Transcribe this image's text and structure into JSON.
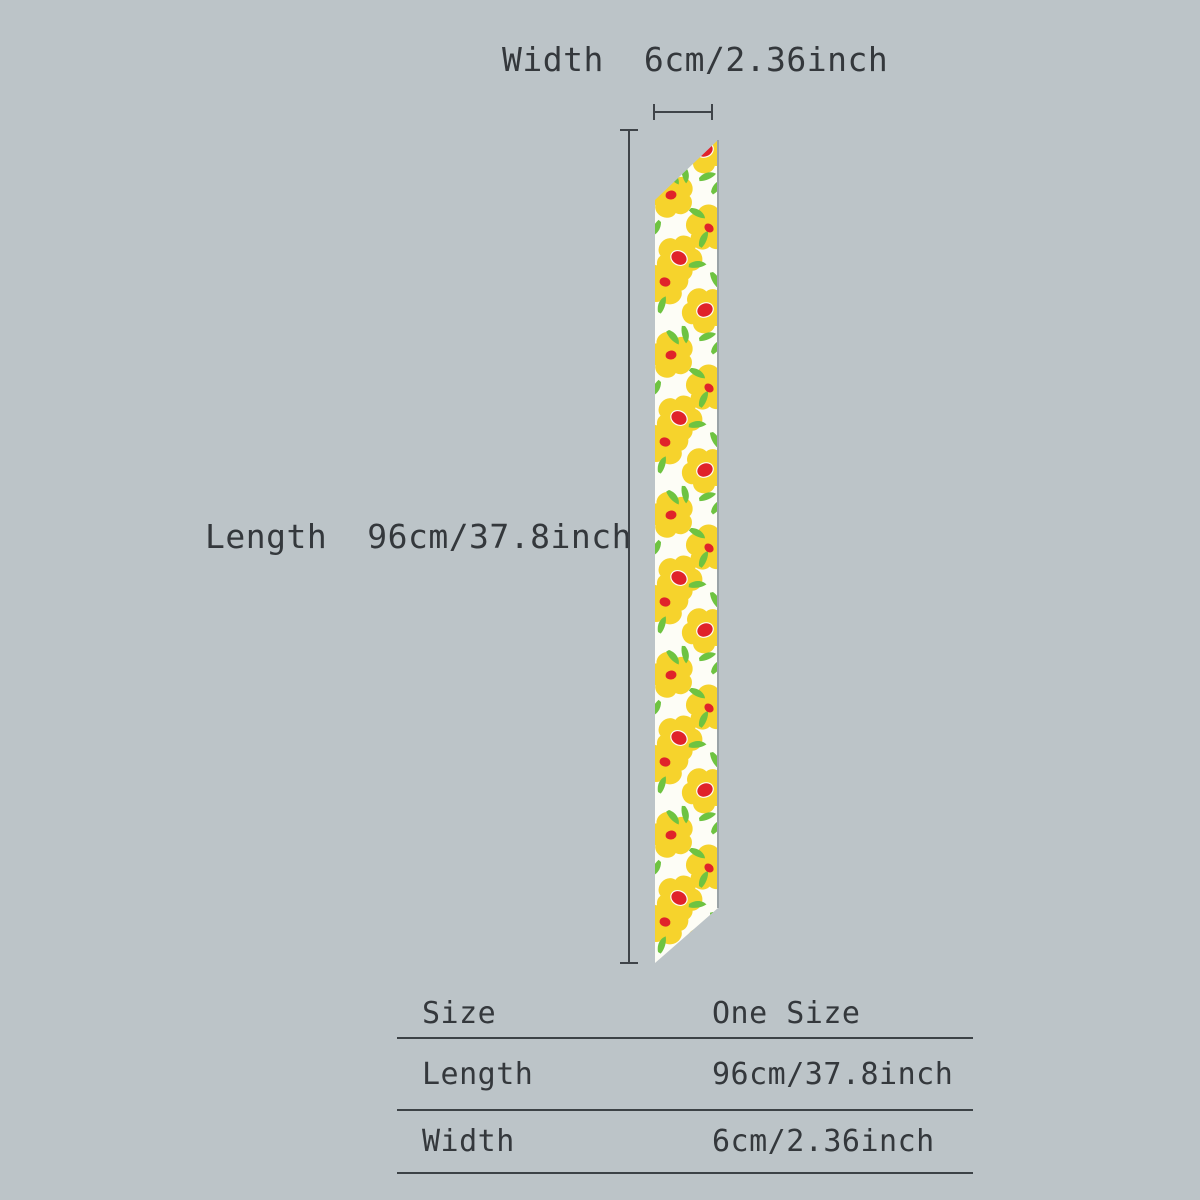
{
  "background": "#bcc4c8",
  "text_color": "#34383c",
  "line_color": "#3f4449",
  "annotations": {
    "width": {
      "label": "Width",
      "value": "6cm/2.36inch"
    },
    "length": {
      "label": "Length",
      "value": "96cm/37.8inch"
    }
  },
  "scarf": {
    "description": "long-skinny-twilly-scarf-yellow-floral-print",
    "base_color": "#fdfdf6",
    "flower_color": "#f6d32c",
    "flower_center_color": "#e0222a",
    "leaf_color": "#6ec341",
    "edge_shadow_color": "#9aa3a7"
  },
  "size_table": {
    "rows": [
      {
        "label": "Size",
        "value": "One Size"
      },
      {
        "label": "Length",
        "value": "96cm/37.8inch"
      },
      {
        "label": "Width",
        "value": "6cm/2.36inch"
      }
    ]
  }
}
